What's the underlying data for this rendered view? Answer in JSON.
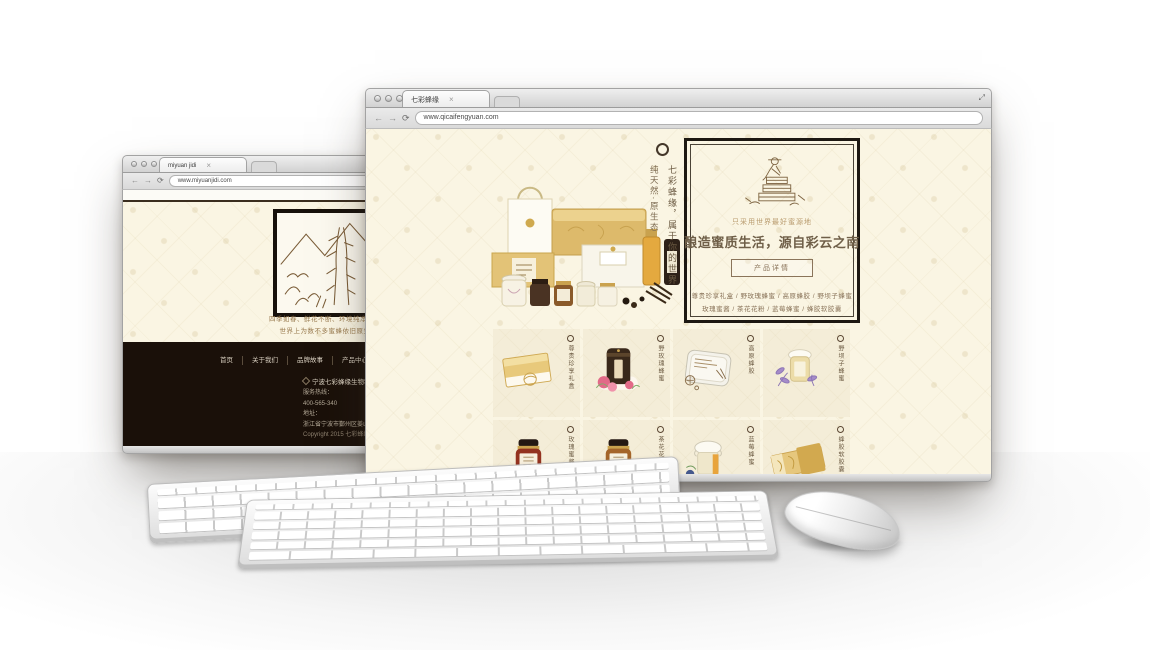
{
  "colors": {
    "cream": "#faf5e3",
    "accent_brown": "#8a745a",
    "title_brown": "#6f5f48",
    "footer_dark": "#1a1009",
    "gold": "#ddba6b"
  },
  "icons": {
    "back": "←",
    "forward": "→",
    "reload": "⟳",
    "tab_close": "×",
    "resize": "⤢"
  },
  "back_window": {
    "tab_title": "miyuan jidi",
    "url": "www.miyuanjidi.com",
    "caption_line1": "四季如春、鲜花不断、环境纯净优美、享受世外桃源，",
    "caption_line2": "世界上为数不多蜜蜂依旧原生态生活着的乐土。",
    "footer": {
      "nav": [
        "首页",
        "关于我们",
        "品牌故事",
        "产品中心",
        "招商加盟",
        "联系我们"
      ],
      "col1": {
        "company": "宁波七彩蜂缘生物科技有限公司",
        "hotline_label": "服务热线：",
        "hotline": "400-565-340",
        "address_label": "地址：",
        "address": "浙江省宁波市鄞州区姜山镇科创中心工业园区"
      },
      "col2": {
        "company": "七彩蜂缘康养体验馆（加盟店）",
        "hotline_label": "服务热线：",
        "hotline": "0574 - 8734 - 4813",
        "address_label": "地址：",
        "address": "宁波市海曙区广安路34号（旗舰店）"
      },
      "copyright": "Copyright 2015 七彩蜂缘 版权所有 浙ICP备12345678号"
    }
  },
  "front_window": {
    "tab_title": "七彩蜂缘",
    "url": "www.qicaifengyuan.com",
    "vertical_tagline_1": "七彩蜂缘，属于你的世界",
    "vertical_tagline_2": "纯天然·原生态",
    "hero": {
      "kicker": "只采用世界最好蜜源地",
      "title": "酿造蜜质生活，源自彩云之南",
      "button": "产品详情",
      "products_line1": "尊贵珍享礼盒 / 野玫瑰蜂蜜 / 高原蜂胶 / 野坝子蜂蜜",
      "products_line2": "玫瑰蜜酱 / 茶花花粉 / 蓝莓蜂蜜 / 蜂胶软胶囊"
    },
    "grid": [
      {
        "label": "尊贵珍享礼盒"
      },
      {
        "label": "野玫瑰蜂蜜"
      },
      {
        "label": "高原蜂胶"
      },
      {
        "label": "野坝子蜂蜜"
      },
      {
        "label": "玫瑰蜜酱"
      },
      {
        "label": "茶花花粉"
      },
      {
        "label": "蓝莓蜂蜜"
      },
      {
        "label": "蜂胶软胶囊"
      }
    ]
  }
}
